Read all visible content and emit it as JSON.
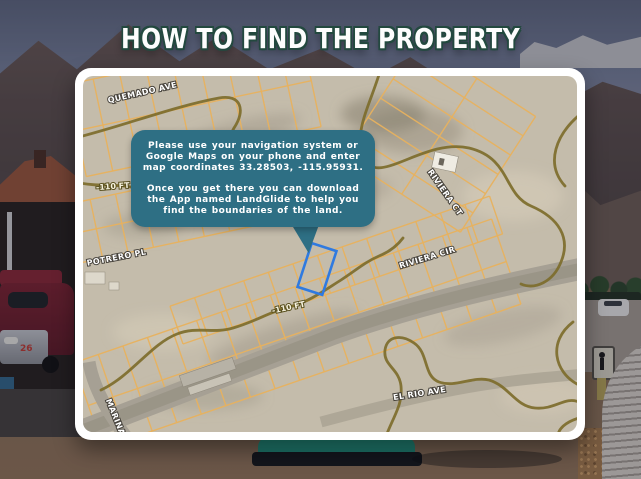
{
  "title": "HOW TO FIND THE PROPERTY",
  "colors": {
    "bubble": "#2e6f84",
    "parcel_lines": "#e8b25e",
    "contours": "#7d6d2b",
    "property_outline": "#2f7ae0",
    "title_outline": "#23493f"
  },
  "speech_bubble": {
    "lines_1": [
      "Please use your navigation system or",
      "Google Maps on your phone and enter",
      "map coordinates 33.28503, -115.95931."
    ],
    "lines_2": [
      "Once you get there you can download",
      "the App named LandGlide to help you",
      "find the boundaries of the land."
    ]
  },
  "map": {
    "labels": {
      "quemado": "QUEMADO AVE",
      "potrero": "POTRERO PL",
      "riviera_ct": "RIVIERA CT",
      "riviera_cir": "RIVIERA CIR",
      "el_rio": "EL RIO AVE",
      "marina": "MARINA"
    },
    "contour_labels": {
      "left": "-110 FT",
      "center": "-110 FT"
    }
  },
  "background": {
    "fire_truck_number": "26"
  }
}
